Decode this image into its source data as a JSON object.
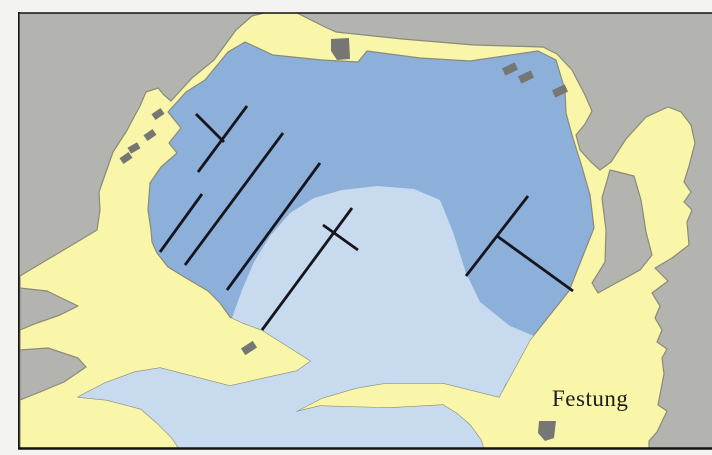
{
  "map": {
    "label": "Festung",
    "label_pos": {
      "x": 552,
      "y": 406,
      "size": 23
    },
    "colors": {
      "margin": "#f3f4f1",
      "map_gray": "#b3b4b0",
      "land": "#f9f6aa",
      "land_stroke": "#8a8a78",
      "water_deep": "#8db0da",
      "water_shallow": "#c8daee",
      "building": "#767674",
      "pier": "#15151f",
      "frame": "#141414",
      "label_color": "#1c1c1c"
    },
    "frame": {
      "x": 18,
      "y": 13,
      "w": 694,
      "h": 436,
      "top_w": 1.6,
      "left_w": 1.6,
      "bottom_w": 2.6
    },
    "land_hull": [
      [
        20,
        276
      ],
      [
        40,
        264
      ],
      [
        67,
        248
      ],
      [
        97,
        230
      ],
      [
        100,
        210
      ],
      [
        99,
        192
      ],
      [
        113,
        152
      ],
      [
        126,
        132
      ],
      [
        140,
        106
      ],
      [
        146,
        92
      ],
      [
        158,
        88
      ],
      [
        164,
        95
      ],
      [
        171,
        101
      ],
      [
        192,
        78
      ],
      [
        214,
        60
      ],
      [
        236,
        30
      ],
      [
        252,
        16
      ],
      [
        264,
        13
      ],
      [
        297,
        13
      ],
      [
        325,
        27
      ],
      [
        336,
        32
      ],
      [
        402,
        39
      ],
      [
        474,
        45
      ],
      [
        543,
        47
      ],
      [
        557,
        54
      ],
      [
        572,
        70
      ],
      [
        585,
        95
      ],
      [
        592,
        111
      ],
      [
        585,
        124
      ],
      [
        576,
        135
      ],
      [
        580,
        150
      ],
      [
        591,
        162
      ],
      [
        600,
        170
      ],
      [
        611,
        162
      ],
      [
        626,
        139
      ],
      [
        646,
        117
      ],
      [
        668,
        107
      ],
      [
        681,
        112
      ],
      [
        691,
        125
      ],
      [
        695,
        143
      ],
      [
        689,
        166
      ],
      [
        684,
        182
      ],
      [
        691,
        192
      ],
      [
        684,
        202
      ],
      [
        692,
        210
      ],
      [
        687,
        222
      ],
      [
        689,
        245
      ],
      [
        672,
        258
      ],
      [
        655,
        268
      ],
      [
        668,
        281
      ],
      [
        652,
        293
      ],
      [
        660,
        306
      ],
      [
        655,
        318
      ],
      [
        662,
        330
      ],
      [
        657,
        342
      ],
      [
        667,
        349
      ],
      [
        662,
        358
      ],
      [
        664,
        374
      ],
      [
        658,
        405
      ],
      [
        667,
        411
      ],
      [
        657,
        432
      ],
      [
        649,
        441
      ],
      [
        649,
        449
      ],
      [
        20,
        449
      ]
    ],
    "water": [
      [
        151,
        230
      ],
      [
        148,
        210
      ],
      [
        150,
        183
      ],
      [
        161,
        167
      ],
      [
        177,
        153
      ],
      [
        169,
        143
      ],
      [
        181,
        128
      ],
      [
        168,
        112
      ],
      [
        186,
        92
      ],
      [
        205,
        80
      ],
      [
        228,
        52
      ],
      [
        245,
        42
      ],
      [
        273,
        55
      ],
      [
        322,
        60
      ],
      [
        358,
        62
      ],
      [
        367,
        51
      ],
      [
        420,
        58
      ],
      [
        470,
        61
      ],
      [
        538,
        51
      ],
      [
        556,
        60
      ],
      [
        565,
        90
      ],
      [
        566,
        113
      ],
      [
        572,
        135
      ],
      [
        582,
        167
      ],
      [
        590,
        195
      ],
      [
        594,
        228
      ],
      [
        569,
        291
      ],
      [
        530,
        340
      ],
      [
        499,
        397
      ],
      [
        443,
        383
      ],
      [
        386,
        383
      ],
      [
        356,
        388
      ],
      [
        322,
        398
      ],
      [
        295,
        412
      ],
      [
        320,
        406
      ],
      [
        389,
        408
      ],
      [
        443,
        405
      ],
      [
        456,
        413
      ],
      [
        470,
        425
      ],
      [
        481,
        440
      ],
      [
        484,
        450
      ],
      [
        180,
        450
      ],
      [
        172,
        438
      ],
      [
        157,
        423
      ],
      [
        141,
        409
      ],
      [
        107,
        400
      ],
      [
        78,
        397
      ],
      [
        105,
        383
      ],
      [
        135,
        372
      ],
      [
        160,
        368
      ],
      [
        195,
        377
      ],
      [
        230,
        386
      ],
      [
        265,
        378
      ],
      [
        297,
        371
      ],
      [
        311,
        361
      ],
      [
        262,
        330
      ],
      [
        243,
        323
      ],
      [
        230,
        317
      ],
      [
        220,
        303
      ],
      [
        208,
        291
      ],
      [
        186,
        278
      ],
      [
        168,
        267
      ],
      [
        157,
        253
      ],
      [
        152,
        242
      ]
    ],
    "shallow": [
      [
        232,
        318
      ],
      [
        242,
        290
      ],
      [
        254,
        262
      ],
      [
        270,
        236
      ],
      [
        290,
        213
      ],
      [
        314,
        198
      ],
      [
        342,
        190
      ],
      [
        378,
        186
      ],
      [
        414,
        189
      ],
      [
        440,
        200
      ],
      [
        453,
        232
      ],
      [
        466,
        273
      ],
      [
        480,
        302
      ],
      [
        510,
        326
      ],
      [
        546,
        341
      ],
      [
        526,
        360
      ],
      [
        505,
        385
      ],
      [
        495,
        412
      ],
      [
        490,
        450
      ],
      [
        60,
        450
      ],
      [
        70,
        400
      ],
      [
        86,
        392
      ],
      [
        128,
        370
      ],
      [
        182,
        360
      ],
      [
        225,
        335
      ]
    ],
    "gray_pockets": [
      [
        [
          20,
          288
        ],
        [
          47,
          291
        ],
        [
          78,
          306
        ],
        [
          60,
          315
        ],
        [
          37,
          323
        ],
        [
          20,
          330
        ]
      ],
      [
        [
          20,
          350
        ],
        [
          48,
          348
        ],
        [
          78,
          358
        ],
        [
          86,
          367
        ],
        [
          64,
          382
        ],
        [
          40,
          392
        ],
        [
          20,
          400
        ]
      ],
      [
        [
          610,
          170
        ],
        [
          634,
          176
        ],
        [
          641,
          200
        ],
        [
          646,
          232
        ],
        [
          652,
          255
        ],
        [
          640,
          270
        ],
        [
          618,
          282
        ],
        [
          598,
          293
        ],
        [
          592,
          283
        ],
        [
          605,
          262
        ],
        [
          606,
          230
        ],
        [
          602,
          198
        ]
      ]
    ],
    "buildings": {
      "rects": [
        {
          "cx": 158,
          "cy": 114,
          "w": 11,
          "h": 7,
          "rot": -35
        },
        {
          "cx": 150,
          "cy": 135,
          "w": 11,
          "h": 7,
          "rot": -35
        },
        {
          "cx": 134,
          "cy": 148,
          "w": 11,
          "h": 7,
          "rot": -30
        },
        {
          "cx": 126,
          "cy": 158,
          "w": 11,
          "h": 7,
          "rot": -35
        },
        {
          "cx": 510,
          "cy": 69,
          "w": 14,
          "h": 8,
          "rot": -25
        },
        {
          "cx": 526,
          "cy": 77,
          "w": 14,
          "h": 8,
          "rot": -25
        },
        {
          "cx": 560,
          "cy": 91,
          "w": 14,
          "h": 8,
          "rot": -25
        },
        {
          "cx": 249,
          "cy": 348,
          "w": 14,
          "h": 8,
          "rot": -33
        }
      ],
      "polys": [
        [
          [
            331,
            39
          ],
          [
            349,
            38
          ],
          [
            350,
            59
          ],
          [
            337,
            60
          ],
          [
            331,
            51
          ]
        ],
        [
          [
            539,
            421
          ],
          [
            556,
            421
          ],
          [
            554,
            438
          ],
          [
            545,
            441
          ],
          [
            538,
            433
          ]
        ]
      ]
    },
    "piers": [
      {
        "x1": 247,
        "y1": 106,
        "x2": 198,
        "y2": 172
      },
      {
        "x1": 196,
        "y1": 114,
        "x2": 224,
        "y2": 142
      },
      {
        "x1": 283,
        "y1": 133,
        "x2": 185,
        "y2": 265
      },
      {
        "x1": 320,
        "y1": 163,
        "x2": 227,
        "y2": 290
      },
      {
        "x1": 202,
        "y1": 194,
        "x2": 160,
        "y2": 252
      },
      {
        "x1": 352,
        "y1": 208,
        "x2": 262,
        "y2": 330
      },
      {
        "x1": 323,
        "y1": 225,
        "x2": 358,
        "y2": 250
      },
      {
        "x1": 528,
        "y1": 196,
        "x2": 466,
        "y2": 276
      },
      {
        "x1": 497,
        "y1": 236,
        "x2": 573,
        "y2": 291
      }
    ],
    "pier_width": 2.8
  }
}
